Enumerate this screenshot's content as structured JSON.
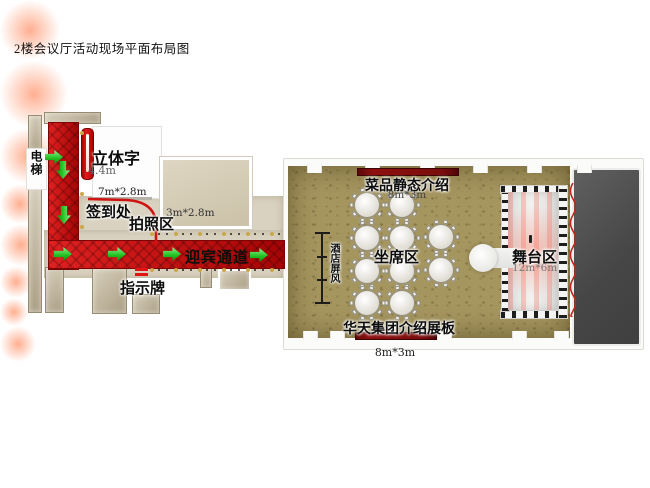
{
  "title": "2楼会议厅活动现场平面布局图",
  "corridor": {
    "elevator_label": "电梯",
    "sign_3d_label": "立体字",
    "sign_3d_height": "4.4m",
    "sign_3d_size": "7m*2.8m",
    "checkin_label": "签到处",
    "photo_area_label": "拍照区",
    "photo_area_size": "3m*2.8m",
    "welcome_channel_label": "迎宾通道",
    "signboard_label": "指示牌"
  },
  "hall": {
    "dish_board_label": "菜品静态介绍",
    "dish_board_size": "8m*3m",
    "seating_label": "坐席区",
    "screen_label": "酒店屏风",
    "stage_label": "舞台区",
    "stage_size": "12m*6m",
    "intro_board_label": "华天集团介绍展板",
    "intro_board_size": "8m*3m"
  },
  "colors": {
    "carpet_red": "#c30d0d",
    "arrow_green": "#35d435",
    "floor_gold": "#a5955f",
    "wall_beige": "#cfc5ae",
    "board_red": "#7a0d0d",
    "backstage_gray": "#4c4c4c",
    "post_gold": "#c9a84c"
  },
  "diagram": {
    "arrows": [
      {
        "x": 54,
        "y": 157,
        "dir": "right"
      },
      {
        "x": 63,
        "y": 170,
        "dir": "down"
      },
      {
        "x": 64,
        "y": 215,
        "dir": "down"
      },
      {
        "x": 63,
        "y": 254,
        "dir": "right"
      },
      {
        "x": 117,
        "y": 254,
        "dir": "right"
      },
      {
        "x": 172,
        "y": 254,
        "dir": "right"
      },
      {
        "x": 259,
        "y": 255,
        "dir": "right"
      }
    ],
    "tables": [
      {
        "x": 367,
        "y": 205
      },
      {
        "x": 402,
        "y": 205
      },
      {
        "x": 367,
        "y": 238
      },
      {
        "x": 402,
        "y": 238
      },
      {
        "x": 441,
        "y": 237
      },
      {
        "x": 367,
        "y": 271
      },
      {
        "x": 402,
        "y": 271
      },
      {
        "x": 441,
        "y": 270
      },
      {
        "x": 367,
        "y": 303
      },
      {
        "x": 402,
        "y": 303
      }
    ],
    "door_notches_top_x": [
      307,
      365,
      420,
      473,
      527,
      577
    ],
    "door_notches_bottom_x": [
      303,
      330,
      384,
      437,
      512,
      554
    ],
    "barrier_rows_y": [
      234,
      270
    ],
    "barrier_x_range": [
      150,
      282
    ],
    "carpet_posts": [
      {
        "x": 80,
        "y": 131
      },
      {
        "x": 80,
        "y": 192
      },
      {
        "x": 80,
        "y": 225
      }
    ],
    "glows": [
      {
        "x": 463,
        "y": 200,
        "r": 30
      },
      {
        "x": 498,
        "y": 248,
        "r": 34
      },
      {
        "x": 472,
        "y": 308,
        "r": 28
      },
      {
        "x": 452,
        "y": 336,
        "r": 20
      },
      {
        "x": 528,
        "y": 204,
        "r": 21
      },
      {
        "x": 432,
        "y": 275,
        "r": 16
      },
      {
        "x": 418,
        "y": 222,
        "r": 14
      },
      {
        "x": 540,
        "y": 290,
        "r": 18
      }
    ]
  }
}
